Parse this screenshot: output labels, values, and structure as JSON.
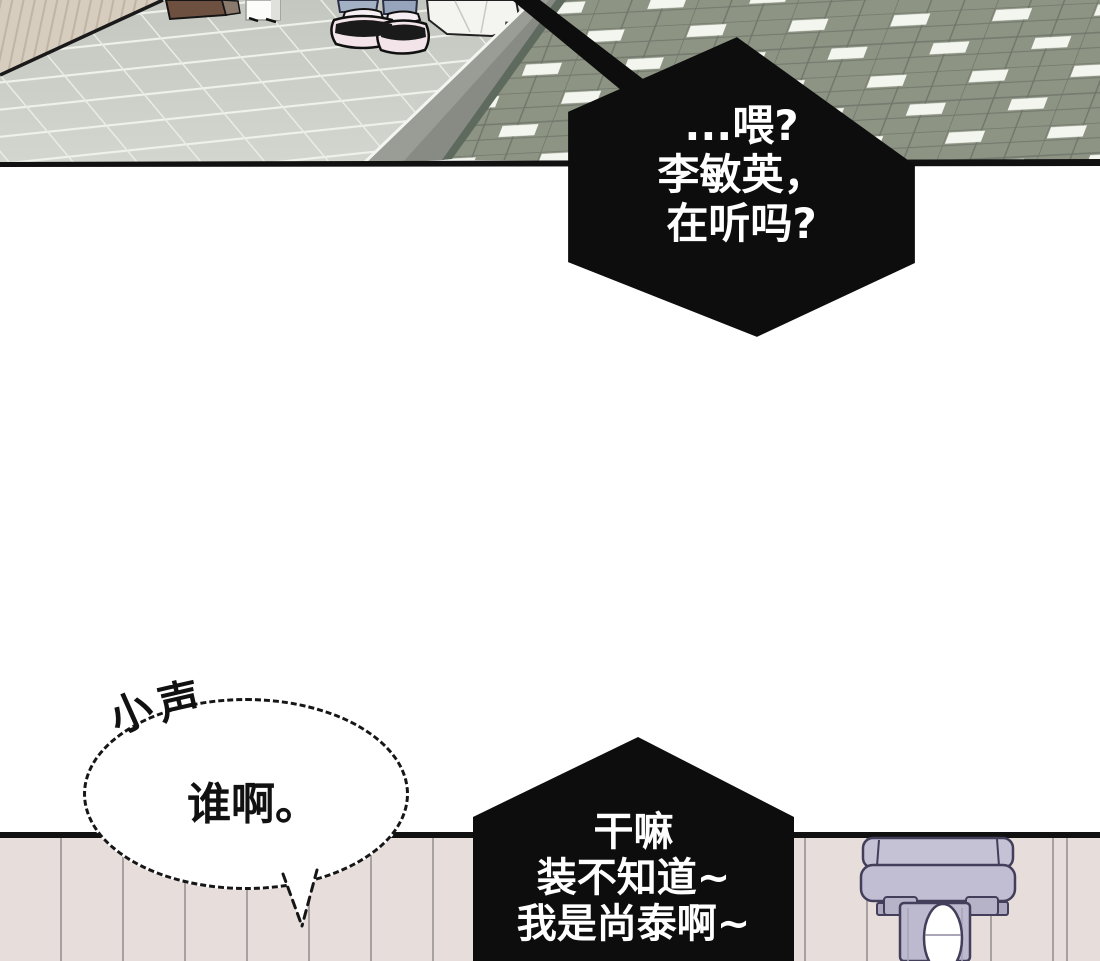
{
  "comic": {
    "panel_count": 3,
    "speech": {
      "bubble_phone_top": {
        "shape": "black-hexagon",
        "lines": [
          "...喂?",
          "李敏英，",
          "在听吗?"
        ],
        "bg": "#0d0d0d",
        "text_color": "#ffffff"
      },
      "bubble_phone_bottom": {
        "shape": "black-hexagon",
        "lines": [
          "干嘛",
          "装不知道~",
          "我是尚泰啊~"
        ],
        "bg": "#0d0d0d",
        "text_color": "#ffffff"
      },
      "bubble_whisper": {
        "shape": "dashed-ellipse",
        "text": "谁啊。",
        "sfx": {
          "char1": "小",
          "char2": "声"
        },
        "text_color": "#111111"
      }
    },
    "colors": {
      "page_bg": "#ffffff",
      "floor_gray": "#c9ccc5",
      "upper_wall_beige": "#d7cdbf",
      "green_tiles": "#8d9483",
      "curb_gray": "#9a9d95",
      "bottom_wall_pink": "#e7dedb",
      "fixture_lavender": "#c1bdd2",
      "ink_black": "#111111"
    }
  }
}
